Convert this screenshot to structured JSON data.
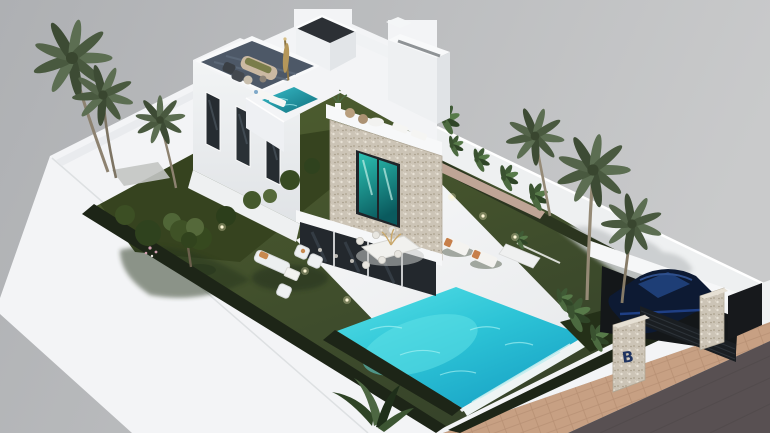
{
  "meta": {
    "title": "Aerial isometric 3D architectural render of a modern two-storey villa plot",
    "view": "aerial three-quarter view, grey studio background"
  },
  "scene": {
    "background": {
      "gradient_left": "#aeb0b3",
      "gradient_right": "#c9cacb"
    },
    "branding": {
      "gate_logo": "B"
    },
    "colors": {
      "wall_white": "#f3f4f6",
      "wall_shade": "#e7e9ec",
      "lawn": "#46532c",
      "hedge": "#1d2517",
      "pool": "#2cc3d6",
      "pool_rim": "#eef4f4",
      "plunge_pool": "#1d97a6",
      "stone": "#ccc4b6",
      "roof_deck": "#4d5867",
      "glass": "#23282d",
      "window_teal": "#1fae9f",
      "road": "#585052",
      "sidewalk": "#c7a083",
      "car_paint": "#0d1a33",
      "car_glass": "#20407a",
      "palm_green": "#55664b",
      "trunk": "#958a76",
      "umbrella": "#b5975a",
      "logo_blue": "#1e3360",
      "planter_soil": "#2b351f",
      "gravel_pink": "#d9b9ac"
    },
    "objects": [
      "modern-white-villa",
      "roof-terrace-lounge",
      "closed-parasol",
      "stair-bulkhead",
      "stone-clad-tower",
      "balcony-plunge-pool",
      "terrace-sun-loungers",
      "swimming-pool",
      "infinity-edge",
      "poolside-loungers",
      "outdoor-dining-set",
      "garden-lounge-set",
      "lawn",
      "garden-tree",
      "shrub-bed",
      "palm-trees",
      "tropical-plants",
      "boundary-wall",
      "wall-planter",
      "garden-lights",
      "carport",
      "parked-car",
      "gate-pillars",
      "gate-logo",
      "sidewalk",
      "road"
    ]
  }
}
